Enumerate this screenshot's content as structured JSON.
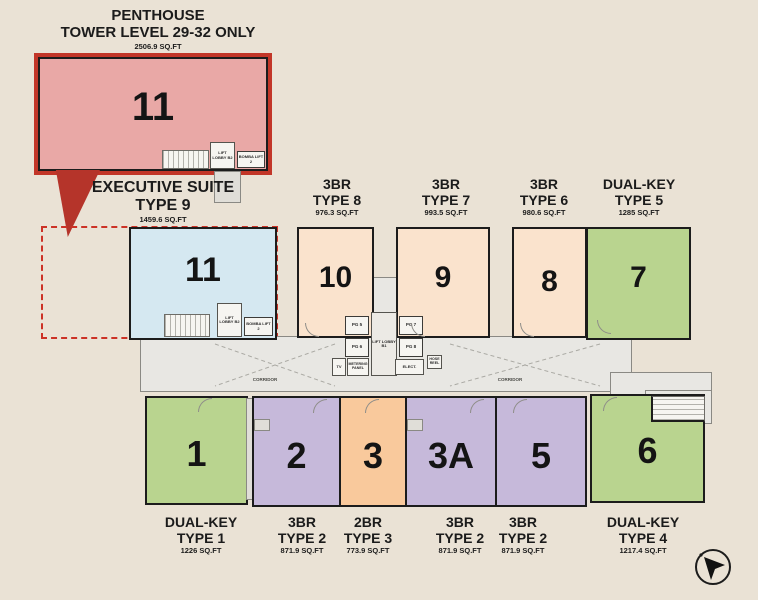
{
  "colors": {
    "background": "#eae2d5",
    "wall": "#1c1c1c",
    "corridor_fill": "#e8e7e3",
    "penthouse_fill": "#e9a8a6",
    "penthouse_border": "#c23628",
    "dashed_outline": "#cc3226",
    "executive_fill": "#d5e8f1",
    "peach_fill": "#fae3cd",
    "green_fill": "#b9d48f",
    "purple_fill": "#c6b9da",
    "orange_fill": "#f9c99c"
  },
  "penthouse": {
    "title_line1": "PENTHOUSE",
    "title_line2": "TOWER LEVEL 29-32 ONLY",
    "area": "2506.9 SQ.FT",
    "unit_number": "11",
    "fill": "#e9a8a6",
    "lift_lobby": "LIFT LOBBY B2",
    "bomba_lift": "BOMBA LIFT 2"
  },
  "executive_suite": {
    "title_line1": "EXECUTIVE SUITE",
    "title_line2": "TYPE 9",
    "area": "1459.6 SQ.FT",
    "unit_number": "11",
    "fill": "#d5e8f1",
    "lift_lobby": "LIFT LOBBY B2",
    "bomba_lift": "BOMBA LIFT 2"
  },
  "top_units": [
    {
      "number": "10",
      "bed_type": "3BR",
      "type_name": "TYPE 8",
      "area": "976.3 SQ.FT",
      "fill": "#fae3cd"
    },
    {
      "number": "9",
      "bed_type": "3BR",
      "type_name": "TYPE 7",
      "area": "993.5 SQ.FT",
      "fill": "#fae3cd"
    },
    {
      "number": "8",
      "bed_type": "3BR",
      "type_name": "TYPE 6",
      "area": "980.6 SQ.FT",
      "fill": "#fae3cd"
    },
    {
      "number": "7",
      "bed_type": "DUAL-KEY",
      "type_name": "TYPE 5",
      "area": "1285 SQ.FT",
      "fill": "#b9d48f"
    }
  ],
  "bottom_units": [
    {
      "number": "1",
      "bed_type": "DUAL-KEY",
      "type_name": "TYPE 1",
      "area": "1226 SQ.FT",
      "fill": "#b9d48f"
    },
    {
      "number": "2",
      "bed_type": "3BR",
      "type_name": "TYPE 2",
      "area": "871.9 SQ.FT",
      "fill": "#c6b9da"
    },
    {
      "number": "3",
      "bed_type": "2BR",
      "type_name": "TYPE 3",
      "area": "773.9 SQ.FT",
      "fill": "#f9c99c"
    },
    {
      "number": "3A",
      "bed_type": "3BR",
      "type_name": "TYPE 2",
      "area": "871.9 SQ.FT",
      "fill": "#c6b9da"
    },
    {
      "number": "5",
      "bed_type": "3BR",
      "type_name": "TYPE 2",
      "area": "871.9 SQ.FT",
      "fill": "#c6b9da"
    },
    {
      "number": "6",
      "bed_type": "DUAL-KEY",
      "type_name": "TYPE 4",
      "area": "1217.4 SQ.FT",
      "fill": "#b9d48f"
    }
  ],
  "core": {
    "lift_lobby": "LIFT LOBBY B1",
    "lift_pg5": "PG 5",
    "lift_pg7": "PG 7",
    "lift_pg6": "PG 6",
    "lift_pg8": "PG 8",
    "room_tv": "TV",
    "room_metering": "METERING PANEL",
    "room_elect": "ELECT.",
    "room_hose_reel": "HOSE REEL",
    "corridor_left": "CORRIDOR",
    "corridor_right": "CORRIDOR"
  }
}
